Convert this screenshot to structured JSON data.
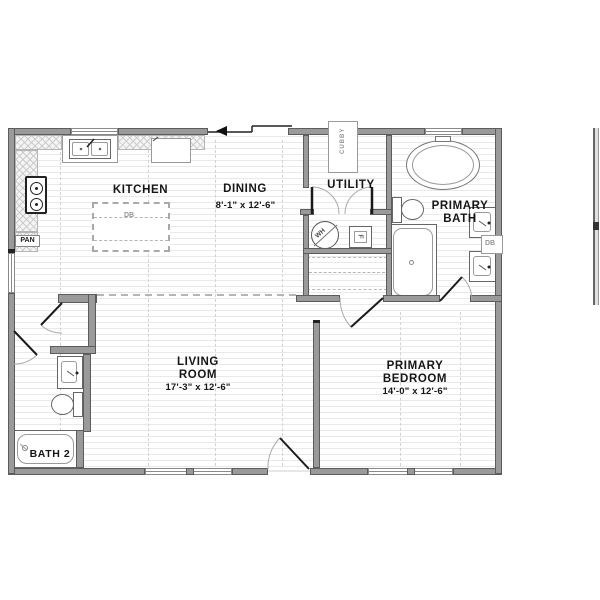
{
  "plan": {
    "type": "floor-plan",
    "rooms": {
      "kitchen": {
        "name": "KITCHEN"
      },
      "dining": {
        "name": "DINING",
        "dims": "8'-1\" x  12'-6\""
      },
      "utility": {
        "name": "UTILITY"
      },
      "primary_bath": {
        "line1": "PRIMARY",
        "line2": "BATH"
      },
      "living_room": {
        "line1": "LIVING",
        "line2": "ROOM",
        "dims": "17'-3\" x  12'-6\""
      },
      "primary_bedroom": {
        "line1": "PRIMARY",
        "line2": "BEDROOM",
        "dims": "14'-0\" x  12'-6\""
      },
      "bath2": {
        "name": "BATH 2"
      }
    },
    "fixtures": {
      "pantry_label": "PAN",
      "cubby_label": "CUBBY",
      "water_heater_label": "WH",
      "furnace_label": "F",
      "island_label": "DB",
      "vanity_label": "DB"
    },
    "colors": {
      "wall_fill": "#9a9a9a",
      "wall_outline": "#5c5c5c",
      "floor_line": "#e9e9e9",
      "hatch_line": "#cccccc",
      "text": "#161616",
      "door_leaf": "#1a1a1a",
      "door_arc": "#aaaaaa"
    }
  }
}
